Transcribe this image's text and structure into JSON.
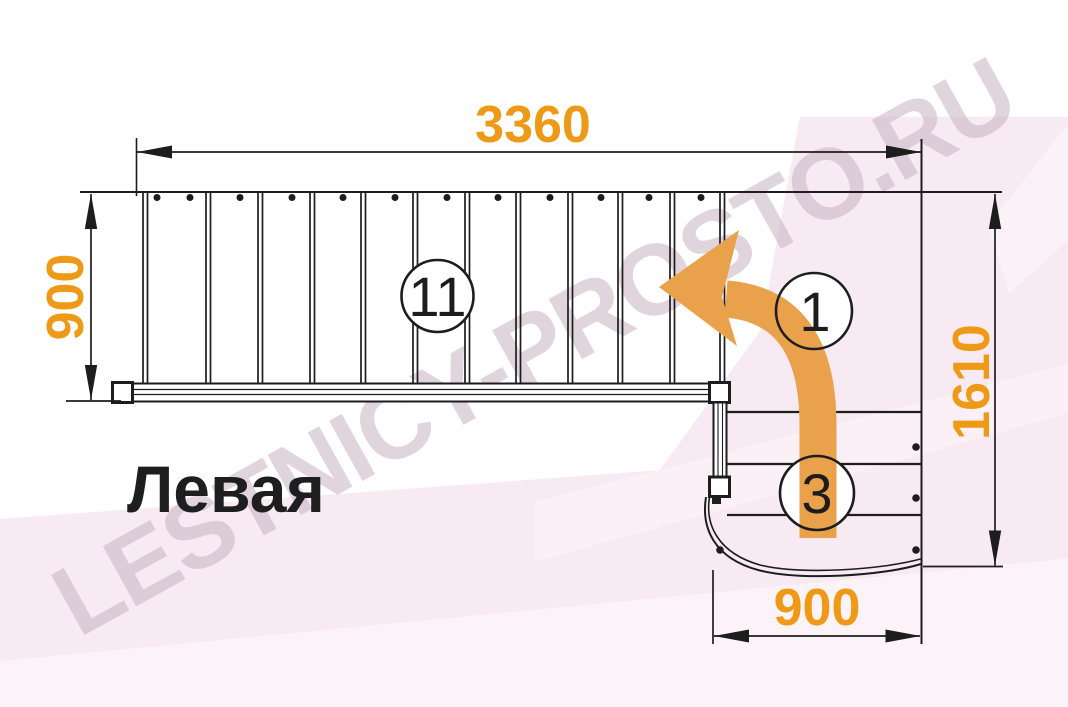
{
  "diagram": {
    "title": "Левая",
    "watermark": "LESTNICY-PROSTO.RU",
    "dimensions": {
      "upper_flight_length_mm": "3360",
      "upper_flight_width_mm": "900",
      "overall_depth_mm": "1610",
      "lower_flight_width_mm": "900"
    },
    "step_labels": {
      "upper_flight_count": "11",
      "turn_step_number": "1",
      "lower_flight_count": "3"
    },
    "icons": {
      "turn_arrow": "curved-left-turn-arrow"
    },
    "colors": {
      "dimension_text": "#EF9A16",
      "arrow_fill": "#EAA14C",
      "line": "#1d1d1d",
      "background_tint": "#F7EAF2"
    }
  }
}
